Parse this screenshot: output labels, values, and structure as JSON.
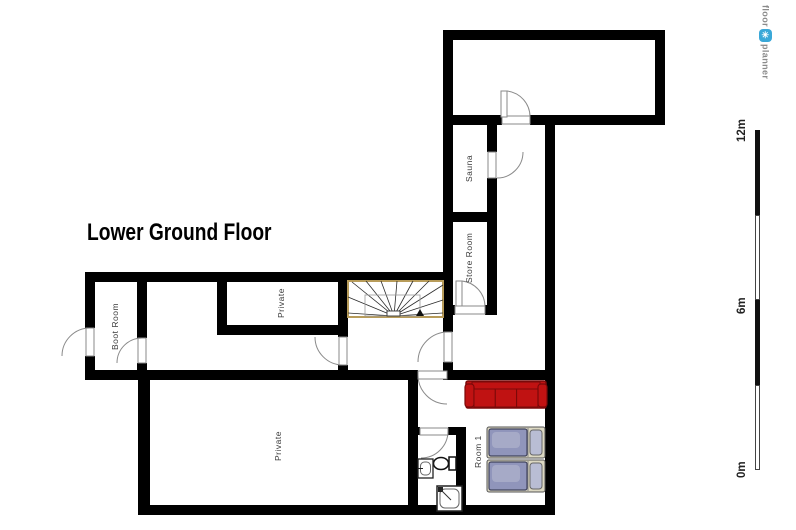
{
  "title": "Lower Ground Floor",
  "rooms": [
    {
      "label": "Boot Room"
    },
    {
      "label": "Private"
    },
    {
      "label": "Sauna"
    },
    {
      "label": "Store Room"
    },
    {
      "label": "Private"
    },
    {
      "label": "Room 1"
    }
  ],
  "scale": {
    "labels": [
      "12m",
      "6m",
      "0m"
    ],
    "unit": "m",
    "max": 12
  },
  "logo": {
    "word1": "floor",
    "word2": "planner",
    "icon": "pinwheel-icon",
    "icon_glyph": "✳"
  },
  "furniture": [
    "sofa",
    "single-bed",
    "single-bed",
    "toilet",
    "sink",
    "shower",
    "winder-staircase"
  ],
  "colors": {
    "wall": "#000000",
    "sofa": "#c01212",
    "sofa_dark": "#7a0909",
    "bed_frame": "#dcd8c2",
    "bed_mattress": "#9095bb",
    "bed_pillow": "#b9bdd4",
    "stair_border": "#b89c5a",
    "door_line": "#8a8a8a",
    "logo_blue": "#3aa8d8",
    "label_text": "#3a3a3a"
  }
}
